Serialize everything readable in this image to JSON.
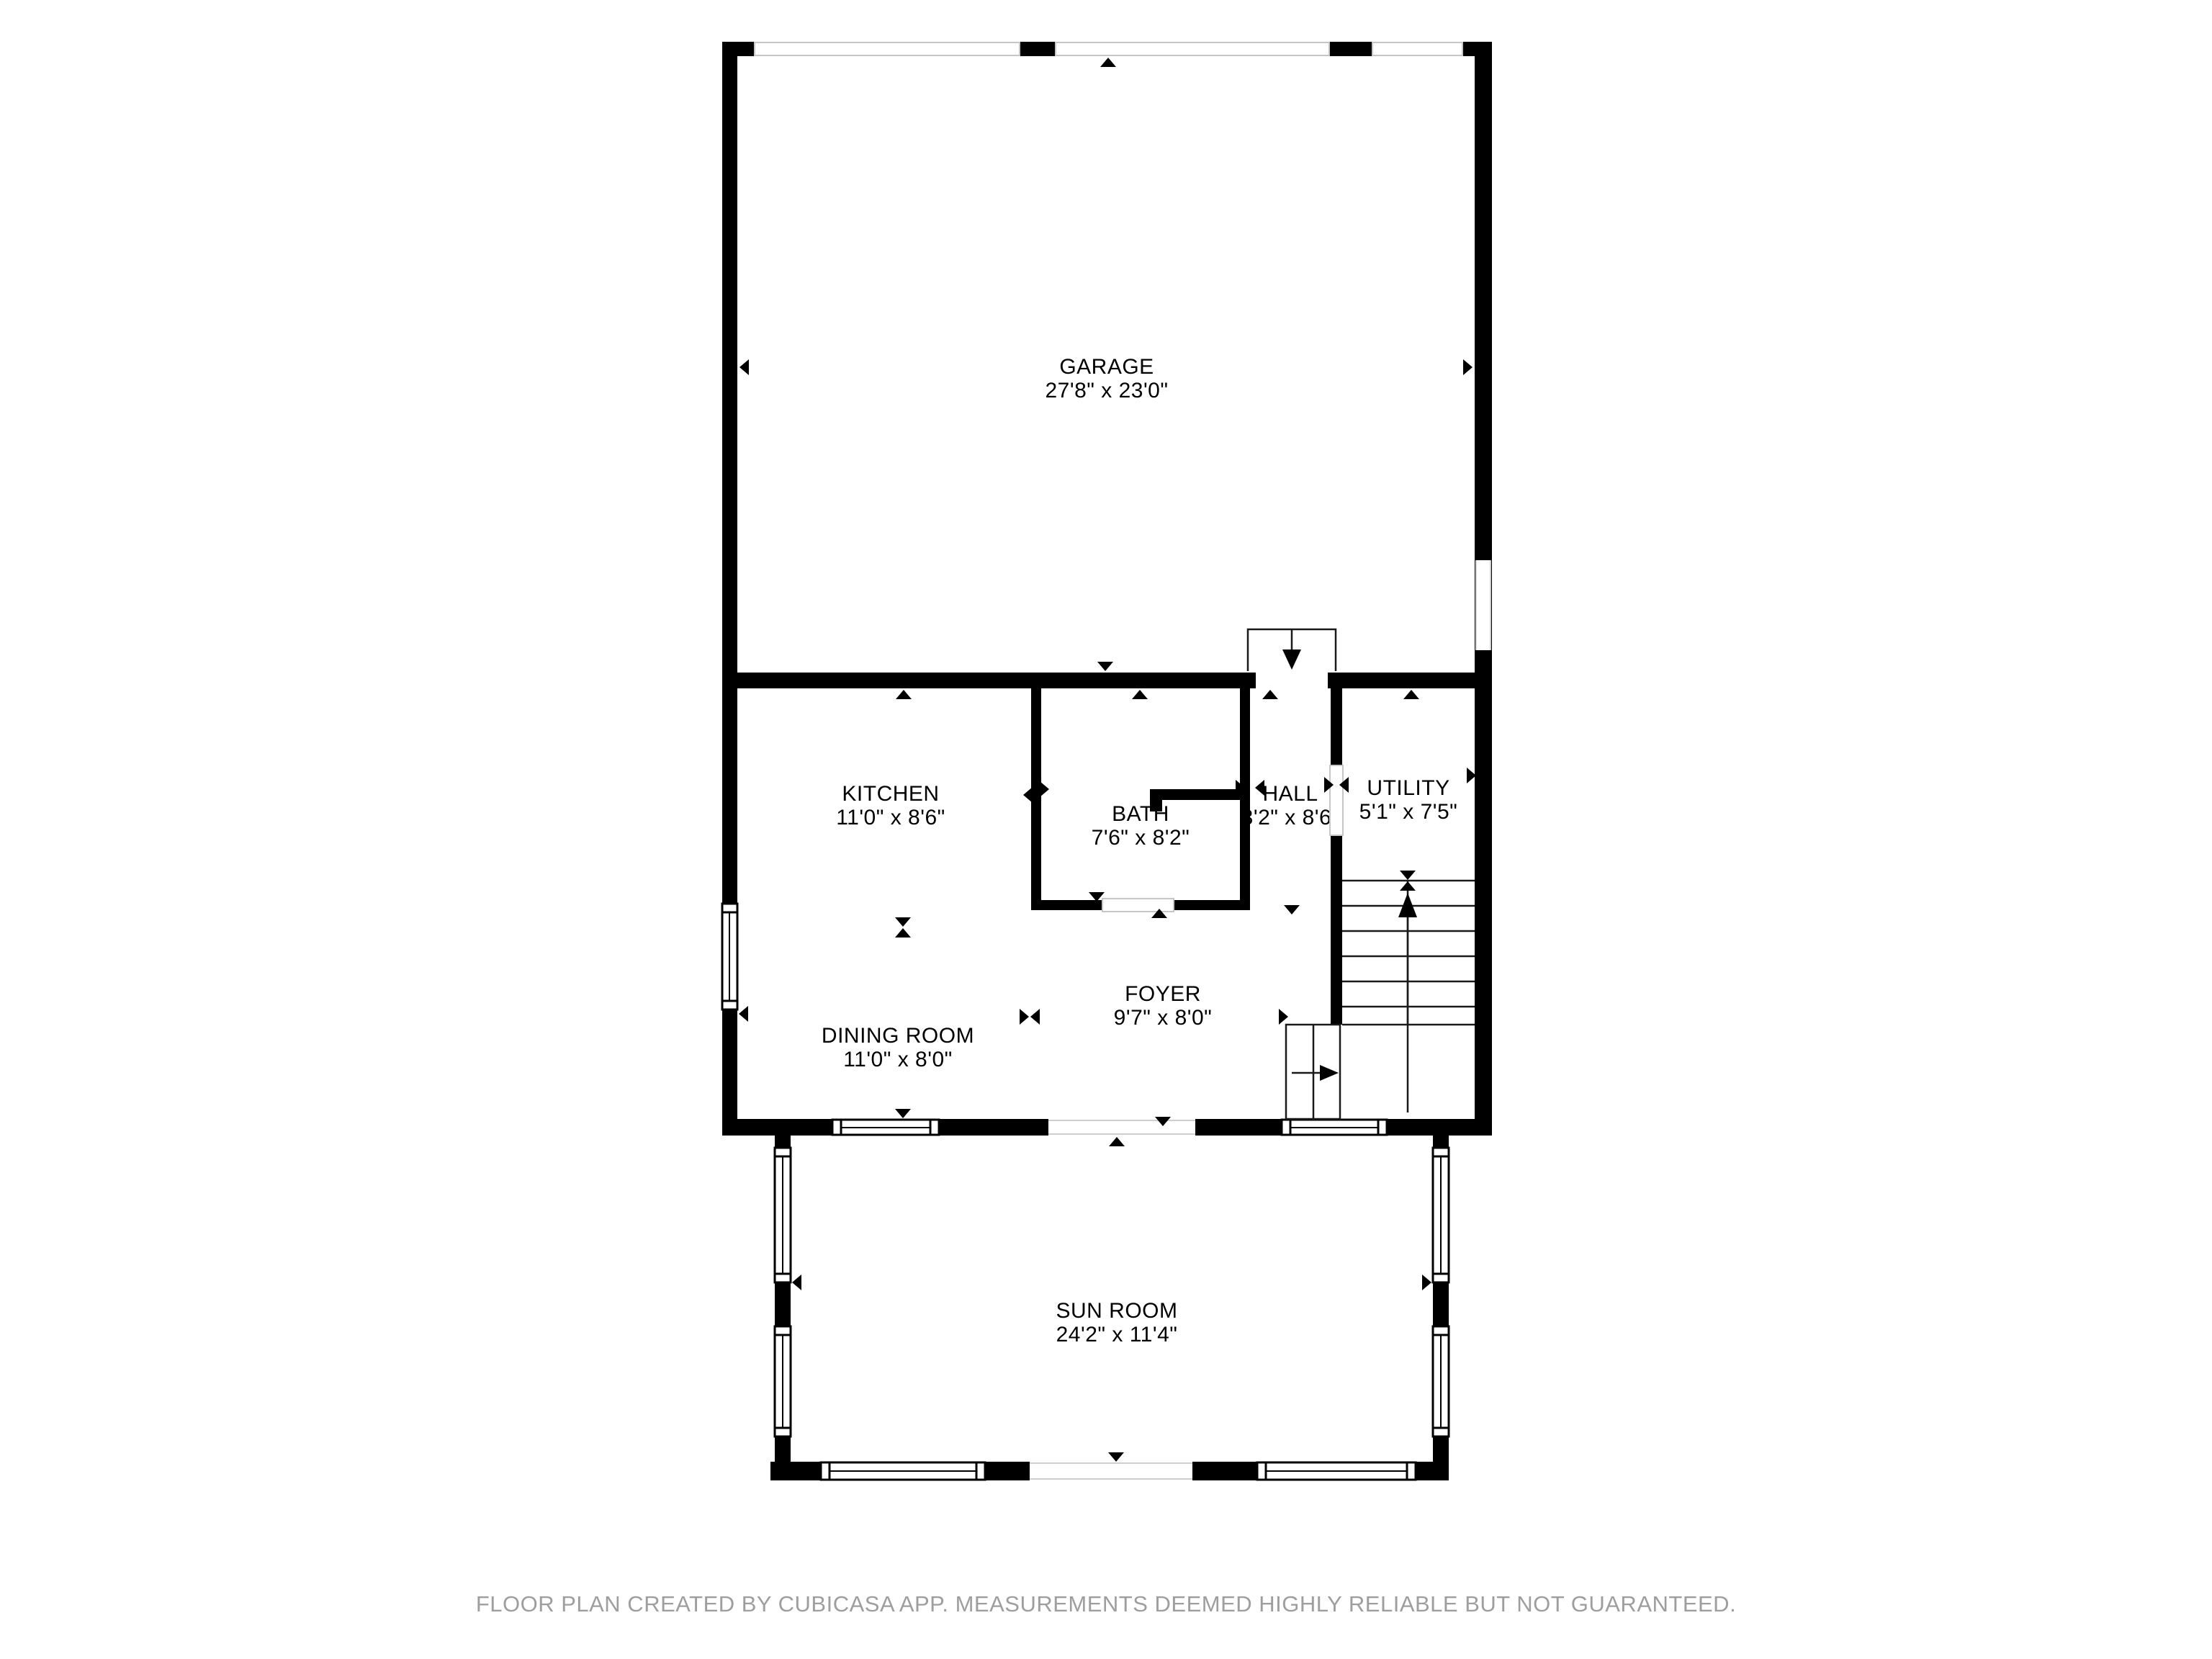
{
  "rooms": {
    "garage": {
      "name": "GARAGE",
      "dims": "27'8\" x 23'0\""
    },
    "kitchen": {
      "name": "KITCHEN",
      "dims": "11'0\" x 8'6\""
    },
    "bath": {
      "name": "BATH",
      "dims": "7'6\" x 8'2\""
    },
    "hall": {
      "name": "HALL",
      "dims": "3'2\" x 8'6\""
    },
    "utility": {
      "name": "UTILITY",
      "dims": "5'1\" x 7'5\""
    },
    "dining": {
      "name": "DINING ROOM",
      "dims": "11'0\" x 8'0\""
    },
    "foyer": {
      "name": "FOYER",
      "dims": "9'7\" x 8'0\""
    },
    "sunroom": {
      "name": "SUN ROOM",
      "dims": "24'2\" x 11'4\""
    }
  },
  "footer": {
    "disclaimer": "FLOOR PLAN CREATED BY CUBICASA APP. MEASUREMENTS DEEMED HIGHLY RELIABLE BUT NOT GUARANTEED."
  },
  "colors": {
    "wall": "#000000",
    "footer_text": "#9e9e9e",
    "opening_outline": "#c6c6c6"
  }
}
